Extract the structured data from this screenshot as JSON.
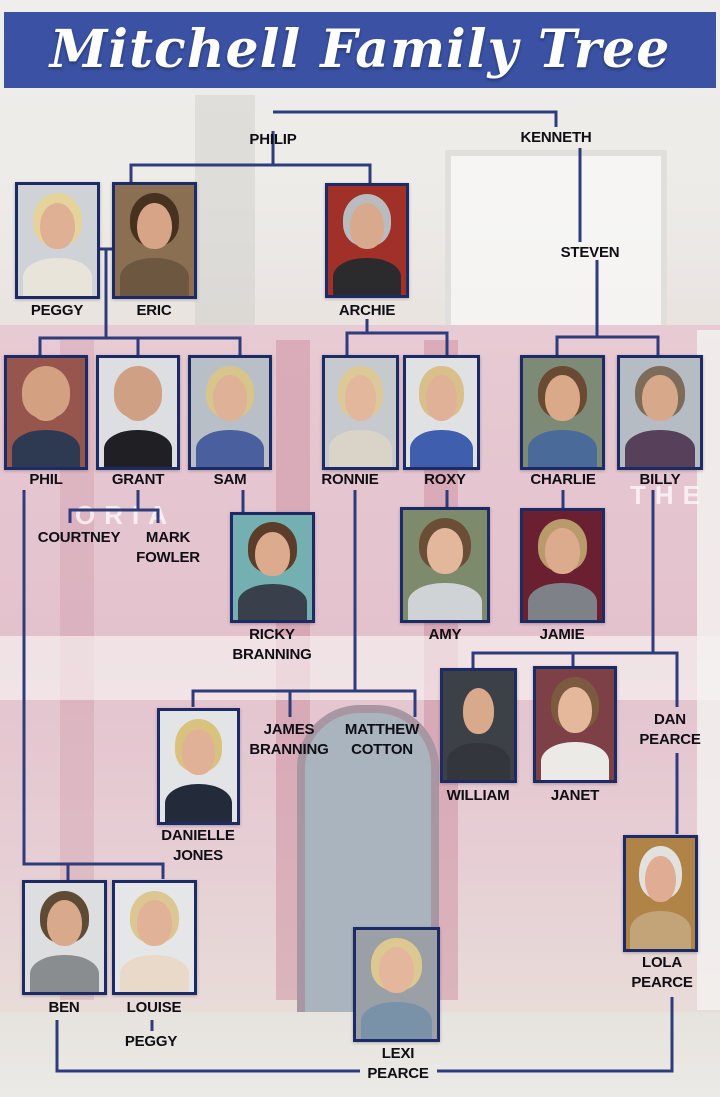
{
  "title": "Mitchell Family Tree",
  "colors": {
    "banner_bg": "#3b52a4",
    "banner_text": "#ffffff",
    "line": "#2e3c7c",
    "photo_border": "#1c2a66",
    "label_text": "#0e0e14"
  },
  "background": {
    "signage_left": "ORIA",
    "signage_right": "THE"
  },
  "tree": {
    "people": [
      {
        "id": "philip",
        "type": "text",
        "lines": [
          "PHILIP"
        ],
        "label_cx": 273,
        "label_y": 130
      },
      {
        "id": "kenneth",
        "type": "text",
        "lines": [
          "KENNETH"
        ],
        "label_cx": 556,
        "label_y": 128
      },
      {
        "id": "steven",
        "type": "text",
        "lines": [
          "STEVEN"
        ],
        "label_cx": 590,
        "label_y": 243
      },
      {
        "id": "peggy",
        "type": "photo",
        "lines": [
          "PEGGY"
        ],
        "label_cx": 57,
        "label_y": 301,
        "photo": {
          "x": 15,
          "y": 182,
          "w": 85,
          "h": 117,
          "bg": "#cfd3d8",
          "hair": "#e4d49c",
          "clothes": "#e9e4da",
          "skin": "#e0b094"
        }
      },
      {
        "id": "eric",
        "type": "photo",
        "lines": [
          "ERIC"
        ],
        "label_cx": 154,
        "label_y": 301,
        "photo": {
          "x": 112,
          "y": 182,
          "w": 85,
          "h": 117,
          "bg": "#8a6f52",
          "hair": "#46321f",
          "clothes": "#6d5740",
          "skin": "#d8a487"
        }
      },
      {
        "id": "archie",
        "type": "photo",
        "lines": [
          "ARCHIE"
        ],
        "label_cx": 367,
        "label_y": 301,
        "photo": {
          "x": 325,
          "y": 183,
          "w": 84,
          "h": 115,
          "bg": "#a03028",
          "hair": "#b9bcbe",
          "clothes": "#2b2b2d",
          "skin": "#d8a98c"
        }
      },
      {
        "id": "phil",
        "type": "photo",
        "lines": [
          "PHIL"
        ],
        "label_cx": 46,
        "label_y": 470,
        "photo": {
          "x": 4,
          "y": 355,
          "w": 84,
          "h": 115,
          "bg": "#96564e",
          "hair": "#d3a082",
          "clothes": "#2e3a52",
          "skin": "#d3a082"
        }
      },
      {
        "id": "grant",
        "type": "photo",
        "lines": [
          "GRANT"
        ],
        "label_cx": 138,
        "label_y": 470,
        "photo": {
          "x": 96,
          "y": 355,
          "w": 84,
          "h": 115,
          "bg": "#dcdee1",
          "hair": "#d0a084",
          "clothes": "#1f1f24",
          "skin": "#d0a084"
        }
      },
      {
        "id": "sam",
        "type": "photo",
        "lines": [
          "SAM"
        ],
        "label_cx": 230,
        "label_y": 470,
        "photo": {
          "x": 188,
          "y": 355,
          "w": 84,
          "h": 115,
          "bg": "#b9bfc6",
          "hair": "#d8c58c",
          "clothes": "#4a5f9e",
          "skin": "#dfb196"
        }
      },
      {
        "id": "ronnie",
        "type": "photo",
        "lines": [
          "RONNIE"
        ],
        "label_cx": 350,
        "label_y": 470,
        "photo": {
          "x": 322,
          "y": 355,
          "w": 77,
          "h": 115,
          "bg": "#c6c9cd",
          "hair": "#ddc996",
          "clothes": "#d9d3c8",
          "skin": "#e2b79b"
        }
      },
      {
        "id": "roxy",
        "type": "photo",
        "lines": [
          "ROXY"
        ],
        "label_cx": 445,
        "label_y": 470,
        "photo": {
          "x": 403,
          "y": 355,
          "w": 77,
          "h": 115,
          "bg": "#dfe1e3",
          "hair": "#d9bf8a",
          "clothes": "#3f5fae",
          "skin": "#e0b196"
        }
      },
      {
        "id": "charlie",
        "type": "photo",
        "lines": [
          "CHARLIE"
        ],
        "label_cx": 563,
        "label_y": 470,
        "photo": {
          "x": 520,
          "y": 355,
          "w": 85,
          "h": 115,
          "bg": "#7d8b76",
          "hair": "#6b4a33",
          "clothes": "#4a6a9a",
          "skin": "#d9a98a"
        }
      },
      {
        "id": "billy",
        "type": "photo",
        "lines": [
          "BILLY"
        ],
        "label_cx": 660,
        "label_y": 470,
        "photo": {
          "x": 617,
          "y": 355,
          "w": 86,
          "h": 115,
          "bg": "#b5bcc4",
          "hair": "#7d6c59",
          "clothes": "#56405a",
          "skin": "#d8a88b"
        }
      },
      {
        "id": "courtney",
        "type": "text",
        "lines": [
          "COURTNEY"
        ],
        "label_cx": 79,
        "label_y": 528
      },
      {
        "id": "mark-fowler",
        "type": "text",
        "lines": [
          "MARK",
          "FOWLER"
        ],
        "label_cx": 168,
        "label_y": 528
      },
      {
        "id": "ricky-branning",
        "type": "photo",
        "lines": [
          "RICKY",
          "BRANNING"
        ],
        "label_cx": 272,
        "label_y": 625,
        "photo": {
          "x": 230,
          "y": 512,
          "w": 85,
          "h": 111,
          "bg": "#74b0b2",
          "hair": "#5a3e2a",
          "clothes": "#3a3f4c",
          "skin": "#dcab8e"
        }
      },
      {
        "id": "amy",
        "type": "photo",
        "lines": [
          "AMY"
        ],
        "label_cx": 445,
        "label_y": 625,
        "photo": {
          "x": 400,
          "y": 507,
          "w": 90,
          "h": 116,
          "bg": "#7e8a6c",
          "hair": "#6b4e36",
          "clothes": "#cfd3d6",
          "skin": "#e3b79c"
        }
      },
      {
        "id": "jamie",
        "type": "photo",
        "lines": [
          "JAMIE"
        ],
        "label_cx": 562,
        "label_y": 625,
        "photo": {
          "x": 520,
          "y": 508,
          "w": 85,
          "h": 115,
          "bg": "#6a2030",
          "hair": "#b99a6a",
          "clothes": "#7e8288",
          "skin": "#dcab8d"
        }
      },
      {
        "id": "james-branning",
        "type": "text",
        "lines": [
          "JAMES",
          "BRANNING"
        ],
        "label_cx": 289,
        "label_y": 720
      },
      {
        "id": "matthew-cotton",
        "type": "text",
        "lines": [
          "MATTHEW",
          "COTTON"
        ],
        "label_cx": 382,
        "label_y": 720
      },
      {
        "id": "dan-pearce",
        "type": "text",
        "lines": [
          "DAN",
          "PEARCE"
        ],
        "label_cx": 670,
        "label_y": 710
      },
      {
        "id": "william",
        "type": "photo",
        "lines": [
          "WILLIAM"
        ],
        "label_cx": 478,
        "label_y": 786,
        "photo": {
          "x": 440,
          "y": 668,
          "w": 77,
          "h": 115,
          "bg": "#3c4147",
          "hair": "#2c2username0",
          "clothes": "#33363c",
          "skin": "#d9a98c"
        }
      },
      {
        "id": "janet",
        "type": "photo",
        "lines": [
          "JANET"
        ],
        "label_cx": 575,
        "label_y": 786,
        "photo": {
          "x": 533,
          "y": 666,
          "w": 84,
          "h": 117,
          "bg": "#7c4046",
          "hair": "#7c5a40",
          "clothes": "#eceae6",
          "skin": "#e5b89c"
        }
      },
      {
        "id": "danielle-jones",
        "type": "photo",
        "lines": [
          "DANIELLE",
          "JONES"
        ],
        "label_cx": 198,
        "label_y": 826,
        "photo": {
          "x": 157,
          "y": 708,
          "w": 83,
          "h": 117,
          "bg": "#e2e4e5",
          "hair": "#d9c27e",
          "clothes": "#232b3a",
          "skin": "#e0b197"
        }
      },
      {
        "id": "ben",
        "type": "photo",
        "lines": [
          "BEN"
        ],
        "label_cx": 64,
        "label_y": 998,
        "photo": {
          "x": 22,
          "y": 880,
          "w": 85,
          "h": 115,
          "bg": "#dcdedf",
          "hair": "#5f4a35",
          "clothes": "#8a8d90",
          "skin": "#d9a98c"
        }
      },
      {
        "id": "louise",
        "type": "photo",
        "lines": [
          "LOUISE"
        ],
        "label_cx": 154,
        "label_y": 998,
        "photo": {
          "x": 112,
          "y": 880,
          "w": 85,
          "h": 115,
          "bg": "#e5e6e7",
          "hair": "#dcc793",
          "clothes": "#e8d9c9",
          "skin": "#e2b298"
        }
      },
      {
        "id": "peggy-jr",
        "type": "text",
        "lines": [
          "PEGGY"
        ],
        "label_cx": 151,
        "label_y": 1032
      },
      {
        "id": "lola-pearce",
        "type": "photo",
        "lines": [
          "LOLA",
          "PEARCE"
        ],
        "label_cx": 662,
        "label_y": 953,
        "photo": {
          "x": 623,
          "y": 835,
          "w": 75,
          "h": 117,
          "bg": "#b08447",
          "hair": "#e3e1dd",
          "clothes": "#c2a478",
          "skin": "#e0ac93"
        }
      },
      {
        "id": "lexi-pearce",
        "type": "photo",
        "lines": [
          "LEXI",
          "PEARCE"
        ],
        "label_cx": 398,
        "label_y": 1044,
        "photo": {
          "x": 353,
          "y": 927,
          "w": 87,
          "h": 115,
          "bg": "#9aa0a6",
          "hair": "#ddc892",
          "clothes": "#7a92a8",
          "skin": "#e4b79c"
        }
      }
    ],
    "connectors": [
      {
        "points": [
          [
            273,
            150
          ],
          [
            273,
            131
          ]
        ]
      },
      {
        "points": [
          [
            273,
            112
          ],
          [
            556,
            112
          ],
          [
            556,
            127
          ]
        ]
      },
      {
        "points": [
          [
            273,
            112
          ],
          [
            273,
            112
          ]
        ]
      },
      {
        "points": [
          [
            273,
            150
          ],
          [
            273,
            165
          ]
        ]
      },
      {
        "points": [
          [
            131,
            182
          ],
          [
            131,
            165
          ],
          [
            370,
            165
          ],
          [
            370,
            183
          ]
        ]
      },
      {
        "points": [
          [
            100,
            249
          ],
          [
            112,
            249
          ]
        ]
      },
      {
        "points": [
          [
            106,
            248
          ],
          [
            106,
            338
          ]
        ]
      },
      {
        "points": [
          [
            40,
            355
          ],
          [
            40,
            338
          ],
          [
            240,
            338
          ],
          [
            240,
            355
          ]
        ]
      },
      {
        "points": [
          [
            138,
            338
          ],
          [
            138,
            355
          ]
        ]
      },
      {
        "points": [
          [
            580,
            148
          ],
          [
            580,
            242
          ]
        ]
      },
      {
        "points": [
          [
            597,
            260
          ],
          [
            597,
            337
          ]
        ]
      },
      {
        "points": [
          [
            557,
            355
          ],
          [
            557,
            337
          ],
          [
            658,
            337
          ],
          [
            658,
            355
          ]
        ]
      },
      {
        "points": [
          [
            367,
            319
          ],
          [
            367,
            333
          ]
        ]
      },
      {
        "points": [
          [
            347,
            355
          ],
          [
            347,
            333
          ],
          [
            447,
            333
          ],
          [
            447,
            355
          ]
        ]
      },
      {
        "points": [
          [
            243,
            490
          ],
          [
            243,
            512
          ]
        ]
      },
      {
        "points": [
          [
            138,
            490
          ],
          [
            138,
            510
          ]
        ]
      },
      {
        "points": [
          [
            70,
            523
          ],
          [
            70,
            510
          ],
          [
            158,
            510
          ],
          [
            158,
            523
          ]
        ]
      },
      {
        "points": [
          [
            24,
            490
          ],
          [
            24,
            864
          ],
          [
            163,
            864
          ],
          [
            163,
            879
          ]
        ]
      },
      {
        "points": [
          [
            68,
            864
          ],
          [
            68,
            880
          ]
        ]
      },
      {
        "points": [
          [
            447,
            490
          ],
          [
            447,
            507
          ]
        ]
      },
      {
        "points": [
          [
            563,
            490
          ],
          [
            563,
            508
          ]
        ]
      },
      {
        "points": [
          [
            355,
            490
          ],
          [
            355,
            691
          ]
        ]
      },
      {
        "points": [
          [
            193,
            707
          ],
          [
            193,
            691
          ],
          [
            415,
            691
          ],
          [
            415,
            717
          ]
        ]
      },
      {
        "points": [
          [
            290,
            691
          ],
          [
            290,
            717
          ]
        ]
      },
      {
        "points": [
          [
            653,
            490
          ],
          [
            653,
            653
          ]
        ]
      },
      {
        "points": [
          [
            473,
            668
          ],
          [
            473,
            653
          ],
          [
            677,
            653
          ],
          [
            677,
            707
          ]
        ]
      },
      {
        "points": [
          [
            573,
            653
          ],
          [
            573,
            666
          ]
        ]
      },
      {
        "points": [
          [
            677,
            753
          ],
          [
            677,
            834
          ]
        ]
      },
      {
        "points": [
          [
            57,
            1020
          ],
          [
            57,
            1071
          ],
          [
            360,
            1071
          ]
        ]
      },
      {
        "points": [
          [
            672,
            997
          ],
          [
            672,
            1071
          ],
          [
            437,
            1071
          ]
        ]
      },
      {
        "points": [
          [
            152,
            1020
          ],
          [
            152,
            1031
          ]
        ]
      }
    ]
  }
}
